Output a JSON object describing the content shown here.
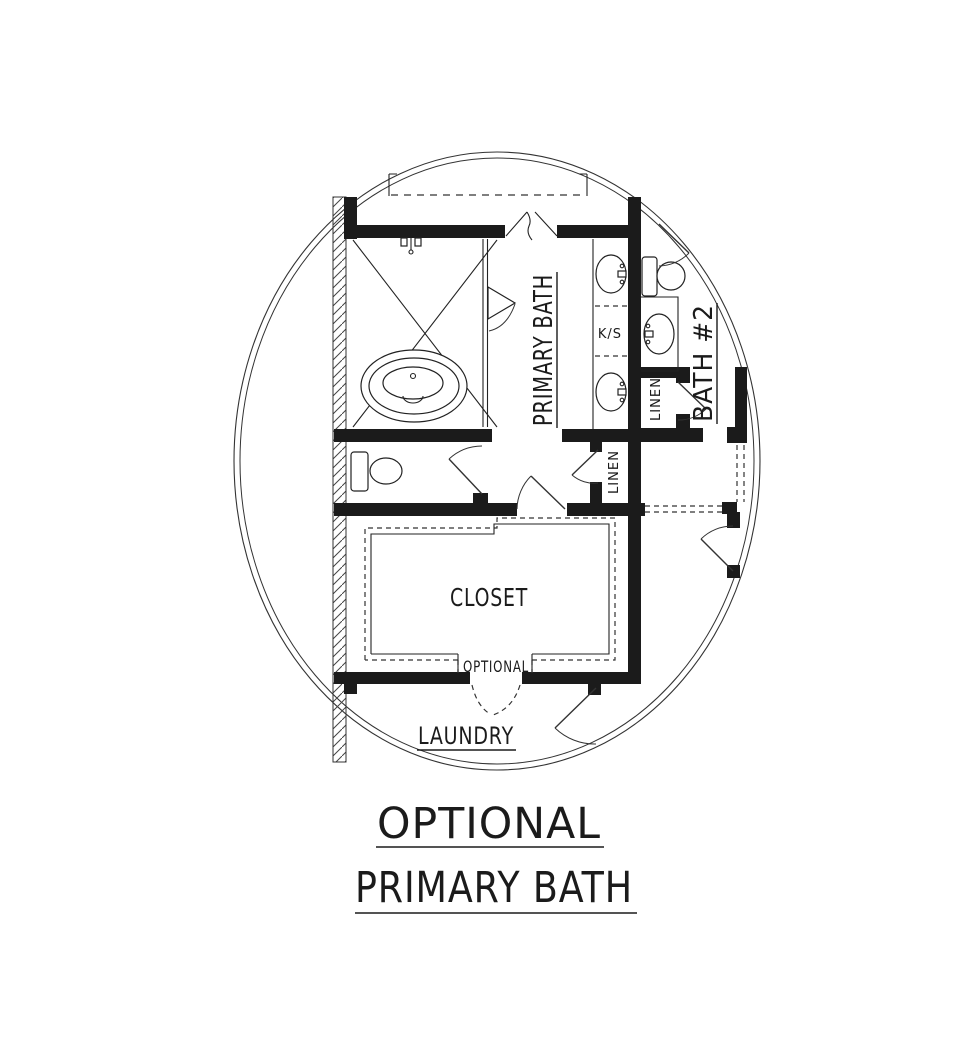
{
  "plan": {
    "labels": {
      "primary_bath": "PRIMARY BATH",
      "bath2": "BATH #2",
      "linen_upper": "LINEN",
      "linen_lower": "LINEN",
      "knee_space": "K/S",
      "closet": "CLOSET",
      "optional_door": "OPTIONAL",
      "laundry": "LAUNDRY"
    },
    "title": {
      "line1": "OPTIONAL",
      "line2": "PRIMARY BATH"
    },
    "colors": {
      "ink": "#1b1b1b",
      "background": "#ffffff"
    }
  }
}
